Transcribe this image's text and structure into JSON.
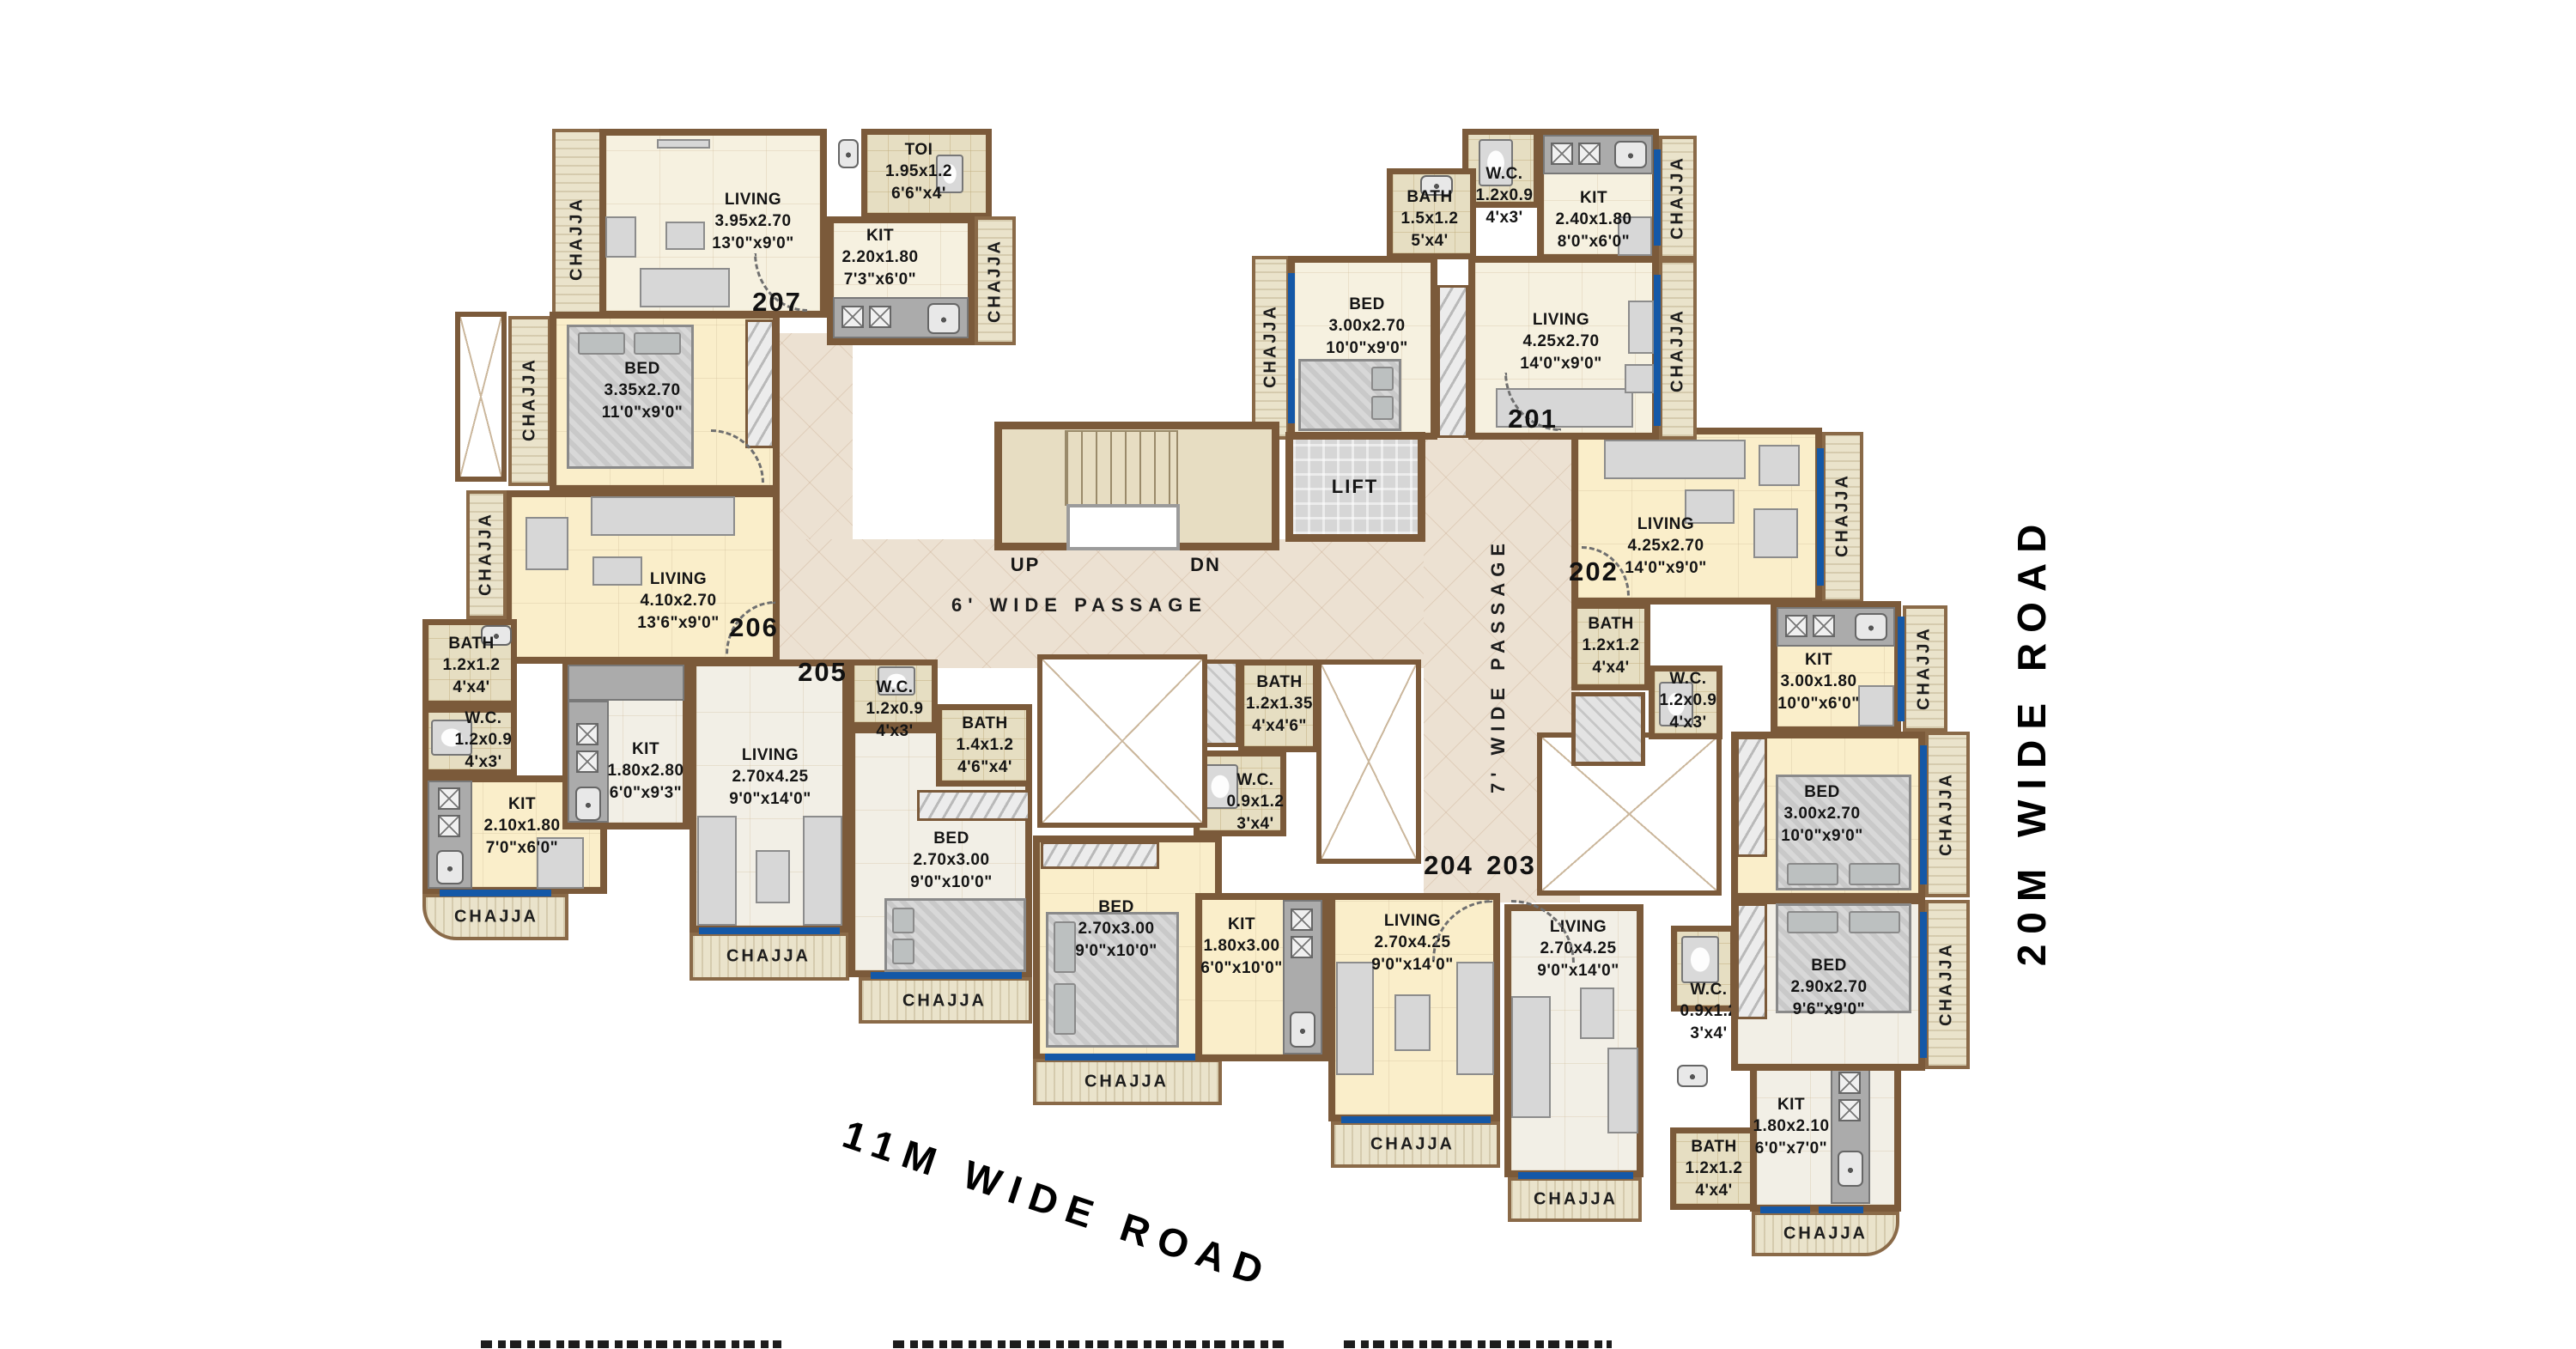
{
  "labels": {
    "chajja": "CHAJJA"
  },
  "core": {
    "lift": "LIFT",
    "up": "UP",
    "dn": "DN"
  },
  "passages": {
    "h": "6' WIDE PASSAGE",
    "v": "7' WIDE PASSAGE"
  },
  "roads": {
    "bottom": "11M WIDE ROAD",
    "right": "20M WIDE ROAD"
  },
  "units": [
    {
      "number": "207",
      "rooms": [
        {
          "name": "LIVING",
          "dim_m": "3.95x2.70",
          "dim_ft": "13'0\"x9'0\""
        },
        {
          "name": "TOI",
          "dim_m": "1.95x1.2",
          "dim_ft": "6'6\"x4'"
        },
        {
          "name": "KIT",
          "dim_m": "2.20x1.80",
          "dim_ft": "7'3\"x6'0\""
        }
      ]
    },
    {
      "number": "206",
      "rooms": [
        {
          "name": "BED",
          "dim_m": "3.35x2.70",
          "dim_ft": "11'0\"x9'0\""
        },
        {
          "name": "LIVING",
          "dim_m": "4.10x2.70",
          "dim_ft": "13'6\"x9'0\""
        },
        {
          "name": "BATH",
          "dim_m": "1.2x1.2",
          "dim_ft": "4'x4'"
        },
        {
          "name": "W.C.",
          "dim_m": "1.2x0.9",
          "dim_ft": "4'x3'"
        },
        {
          "name": "KIT",
          "dim_m": "2.10x1.80",
          "dim_ft": "7'0\"x6'0\""
        }
      ]
    },
    {
      "number": "205",
      "rooms": [
        {
          "name": "KIT",
          "dim_m": "1.80x2.80",
          "dim_ft": "6'0\"x9'3\""
        },
        {
          "name": "LIVING",
          "dim_m": "2.70x4.25",
          "dim_ft": "9'0\"x14'0\""
        },
        {
          "name": "W.C.",
          "dim_m": "1.2x0.9",
          "dim_ft": "4'x3'"
        },
        {
          "name": "BATH",
          "dim_m": "1.4x1.2",
          "dim_ft": "4'6\"x4'"
        },
        {
          "name": "BED",
          "dim_m": "2.70x3.00",
          "dim_ft": "9'0\"x10'0\""
        }
      ]
    },
    {
      "number": "204",
      "rooms": [
        {
          "name": "BED",
          "dim_m": "2.70x3.00",
          "dim_ft": "9'0\"x10'0\""
        },
        {
          "name": "BATH",
          "dim_m": "1.2x1.35",
          "dim_ft": "4'x4'6\""
        },
        {
          "name": "W.C.",
          "dim_m": "0.9x1.2",
          "dim_ft": "3'x4'"
        },
        {
          "name": "KIT",
          "dim_m": "1.80x3.00",
          "dim_ft": "6'0\"x10'0\""
        },
        {
          "name": "LIVING",
          "dim_m": "2.70x4.25",
          "dim_ft": "9'0\"x14'0\""
        }
      ]
    },
    {
      "number": "203",
      "rooms": [
        {
          "name": "LIVING",
          "dim_m": "2.70x4.25",
          "dim_ft": "9'0\"x14'0\""
        },
        {
          "name": "W.C.",
          "dim_m": "0.9x1.2",
          "dim_ft": "3'x4'"
        },
        {
          "name": "BATH",
          "dim_m": "1.2x1.2",
          "dim_ft": "4'x4'"
        },
        {
          "name": "KIT",
          "dim_m": "1.80x2.10",
          "dim_ft": "6'0\"x7'0\""
        },
        {
          "name": "BED",
          "dim_m": "2.90x2.70",
          "dim_ft": "9'6\"x9'0\""
        }
      ]
    },
    {
      "number": "202",
      "rooms": [
        {
          "name": "LIVING",
          "dim_m": "4.25x2.70",
          "dim_ft": "14'0\"x9'0\""
        },
        {
          "name": "BATH",
          "dim_m": "1.2x1.2",
          "dim_ft": "4'x4'"
        },
        {
          "name": "W.C.",
          "dim_m": "1.2x0.9",
          "dim_ft": "4'x3'"
        },
        {
          "name": "KIT",
          "dim_m": "3.00x1.80",
          "dim_ft": "10'0\"x6'0\""
        },
        {
          "name": "BED",
          "dim_m": "3.00x2.70",
          "dim_ft": "10'0\"x9'0\""
        }
      ]
    },
    {
      "number": "201",
      "rooms": [
        {
          "name": "BATH",
          "dim_m": "1.5x1.2",
          "dim_ft": "5'x4'"
        },
        {
          "name": "W.C.",
          "dim_m": "1.2x0.9",
          "dim_ft": "4'x3'"
        },
        {
          "name": "KIT",
          "dim_m": "2.40x1.80",
          "dim_ft": "8'0\"x6'0\""
        },
        {
          "name": "BED",
          "dim_m": "3.00x2.70",
          "dim_ft": "10'0\"x9'0\""
        },
        {
          "name": "LIVING",
          "dim_m": "4.25x2.70",
          "dim_ft": "14'0\"x9'0\""
        }
      ]
    }
  ]
}
